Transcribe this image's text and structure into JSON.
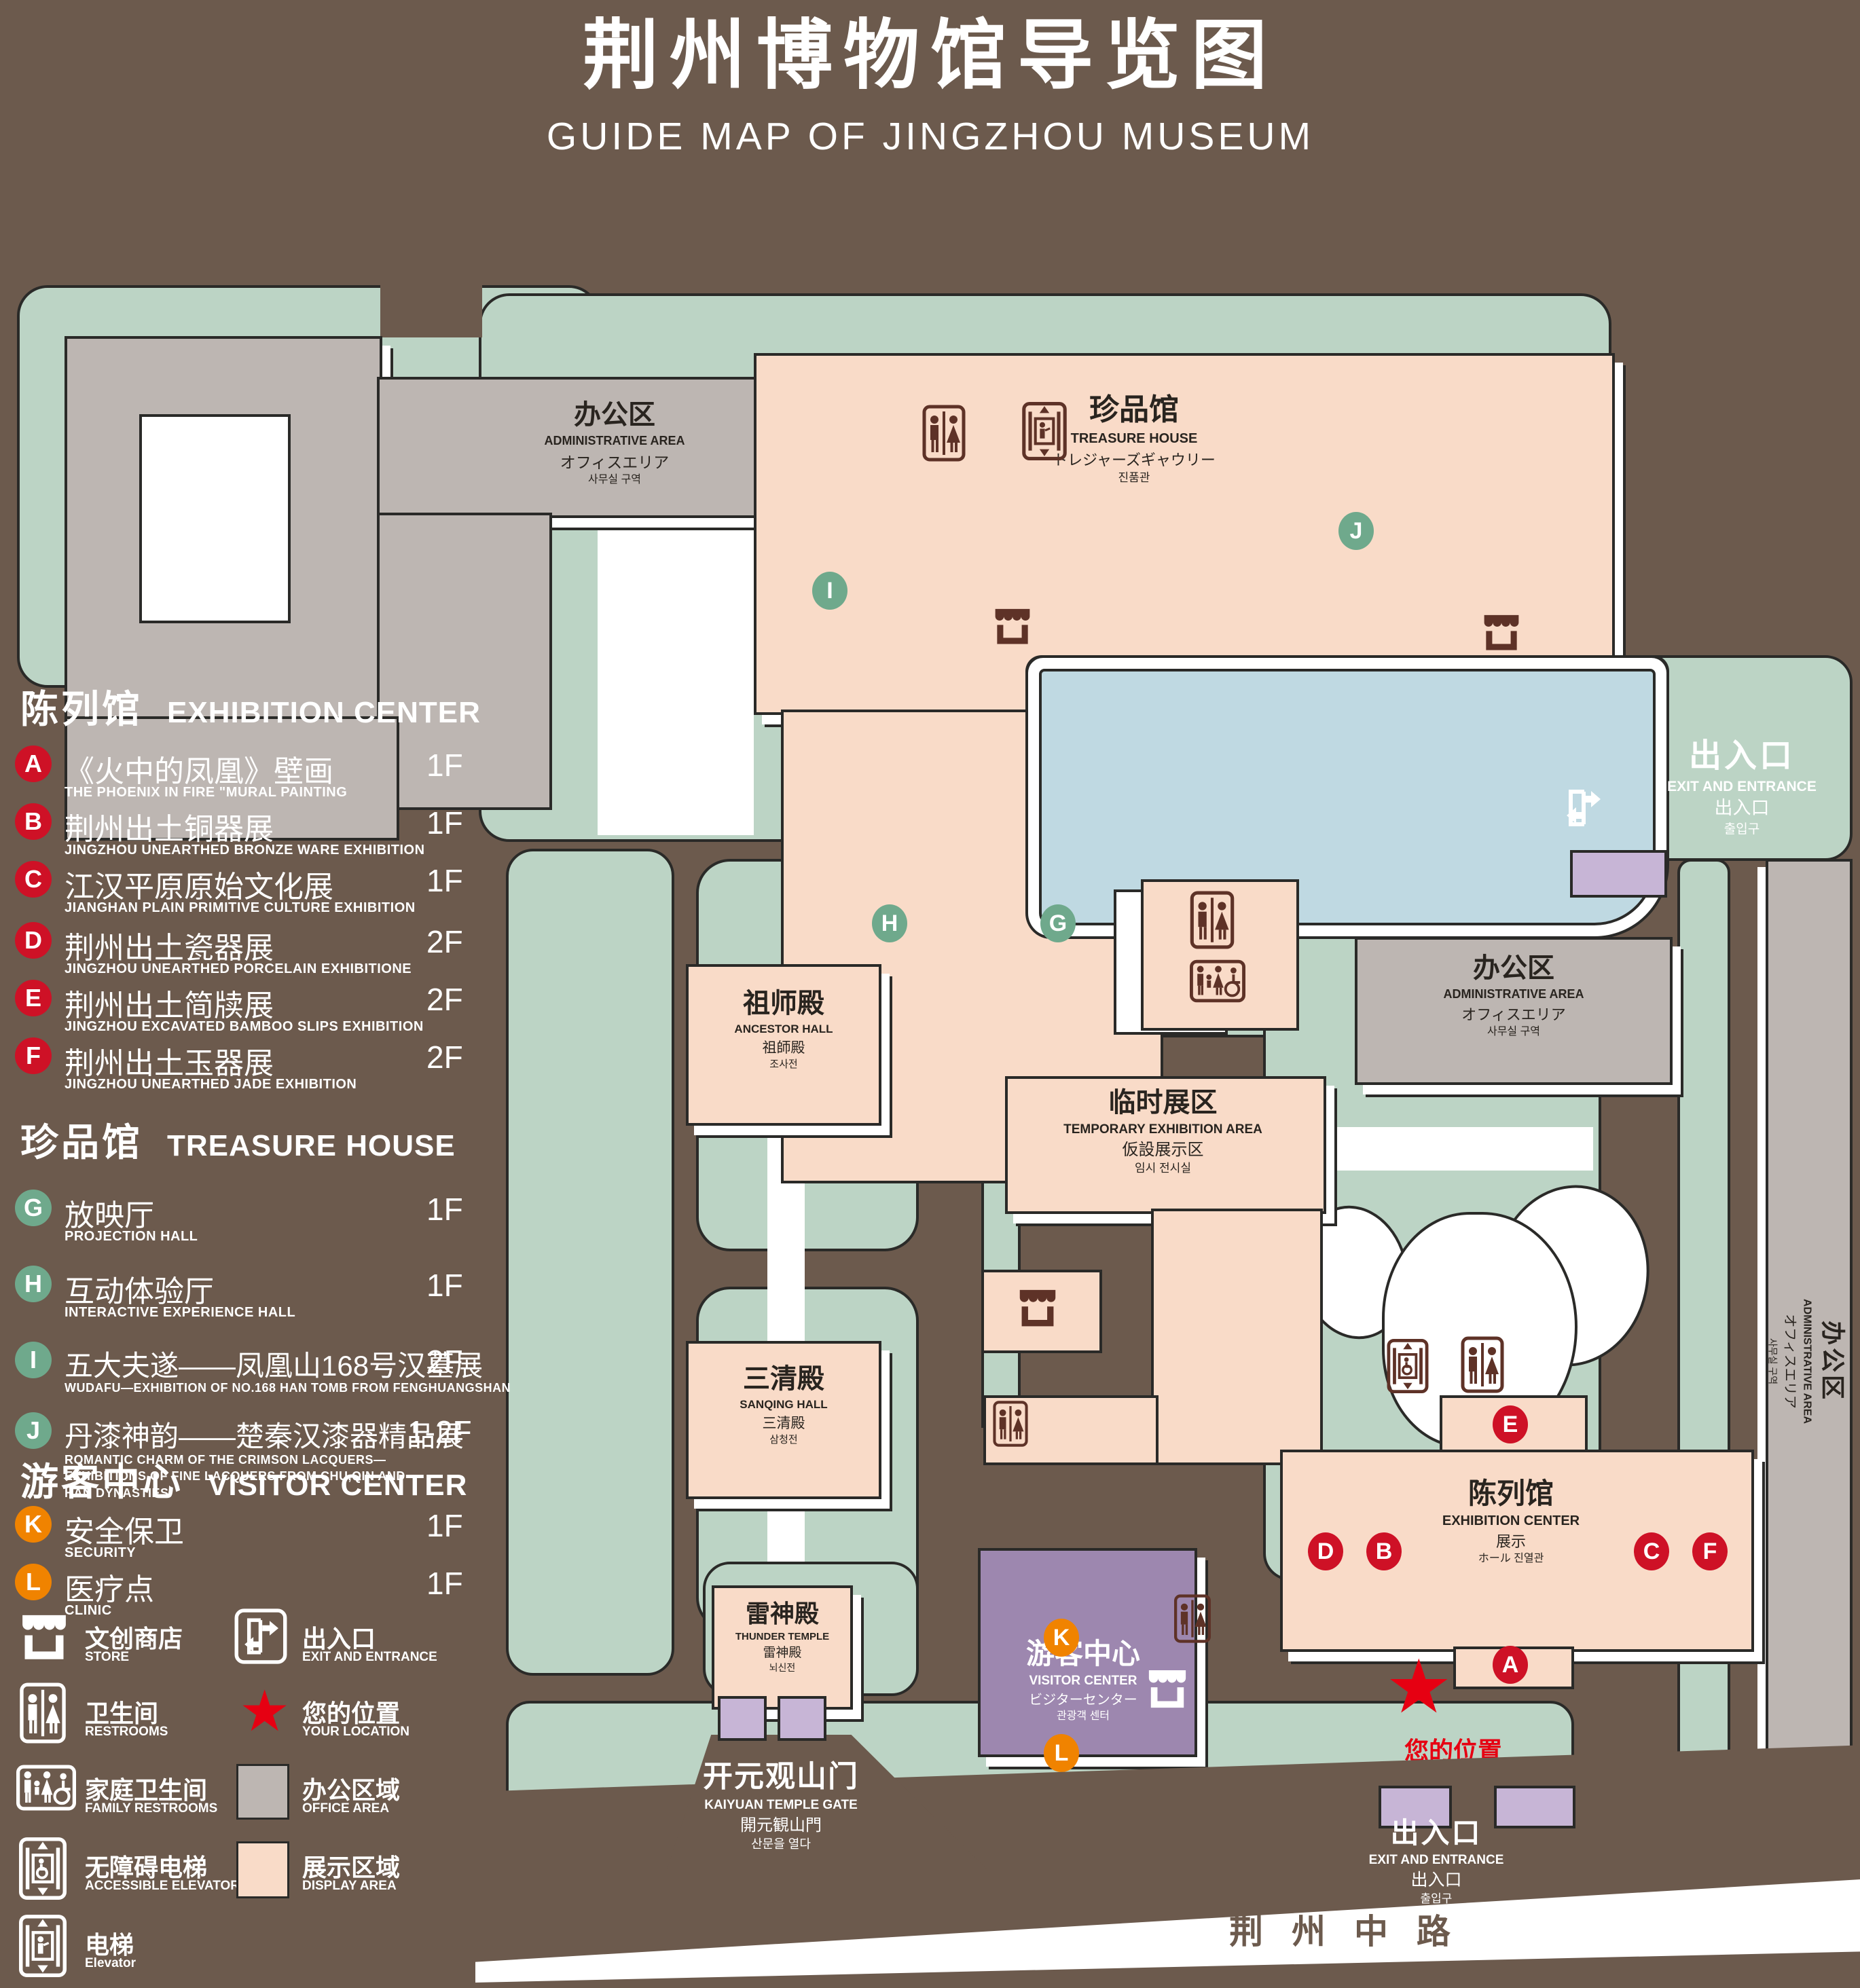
{
  "title": {
    "zh": "荆州博物馆导览图",
    "en": "GUIDE MAP OF JINGZHOU MUSEUM"
  },
  "legend": {
    "sections": [
      {
        "zh": "陈列馆",
        "en": "EXHIBITION CENTER",
        "items": [
          {
            "letter": "A",
            "zh": "《火中的凤凰》壁画",
            "en": "THE PHOENIX IN FIRE \"MURAL PAINTING",
            "floor": "1F"
          },
          {
            "letter": "B",
            "zh": "荆州出土铜器展",
            "en": "JINGZHOU UNEARTHED BRONZE WARE EXHIBITION",
            "floor": "1F"
          },
          {
            "letter": "C",
            "zh": "江汉平原原始文化展",
            "en": "JIANGHAN PLAIN PRIMITIVE CULTURE EXHIBITION",
            "floor": "1F"
          },
          {
            "letter": "D",
            "zh": "荆州出土瓷器展",
            "en": "JINGZHOU UNEARTHED PORCELAIN EXHIBITIONE",
            "floor": "2F"
          },
          {
            "letter": "E",
            "zh": "荆州出土简牍展",
            "en": "JINGZHOU EXCAVATED BAMBOO SLIPS EXHIBITION",
            "floor": "2F"
          },
          {
            "letter": "F",
            "zh": "荆州出土玉器展",
            "en": "JINGZHOU UNEARTHED JADE EXHIBITION",
            "floor": "2F"
          }
        ]
      },
      {
        "zh": "珍品馆",
        "en": "TREASURE HOUSE",
        "items": [
          {
            "letter": "G",
            "zh": "放映厅",
            "en": "PROJECTION HALL",
            "floor": "1F"
          },
          {
            "letter": "H",
            "zh": "互动体验厅",
            "en": "INTERACTIVE EXPERIENCE HALL",
            "floor": "1F"
          },
          {
            "letter": "I",
            "zh": "五大夫遂——凤凰山168号汉墓展",
            "en": "WUDAFU—EXHIBITION OF NO.168 HAN TOMB FROM FENGHUANGSHAN",
            "floor": "2F"
          },
          {
            "letter": "J",
            "zh": "丹漆神韵——楚秦汉漆器精品展",
            "en": "ROMANTIC CHARM OF THE CRIMSON LACQUERS—EXHIBITIONS OF FINE LACQUERS FROM CHU,QIN AND HAN DYNASTIES",
            "floor": "1-2F"
          }
        ]
      },
      {
        "zh": "游客中心",
        "en": "VISITOR CENTER",
        "items": [
          {
            "letter": "K",
            "zh": "安全保卫",
            "en": "SECURITY",
            "floor": "1F"
          },
          {
            "letter": "L",
            "zh": "医疗点",
            "en": "CLINIC",
            "floor": "1F"
          }
        ]
      }
    ],
    "symbols": [
      {
        "zh": "文创商店",
        "en": "STORE"
      },
      {
        "zh": "出入口",
        "en": "EXIT AND ENTRANCE"
      },
      {
        "zh": "卫生间",
        "en": "RESTROOMS"
      },
      {
        "zh": "您的位置",
        "en": "YOUR LOCATION"
      },
      {
        "zh": "家庭卫生间",
        "en": "FAMILY RESTROOMS"
      },
      {
        "zh": "办公区域",
        "en": "OFFICE AREA"
      },
      {
        "zh": "无障碍电梯",
        "en": "ACCESSIBLE ELEVATOR"
      },
      {
        "zh": "展示区域",
        "en": "DISPLAY AREA"
      },
      {
        "zh": "电梯",
        "en": "Elevator"
      }
    ]
  },
  "map": {
    "treasure_house": {
      "zh": "珍品馆",
      "en": "TREASURE HOUSE",
      "ja": "トレジャーズギャウリー",
      "ko": "진품관"
    },
    "admin_area": {
      "zh": "办公区",
      "en": "ADMINISTRATIVE AREA",
      "ja": "オフィスエリア",
      "ko": "사무실 구역"
    },
    "ancestor_hall": {
      "zh": "祖师殿",
      "en": "ANCESTOR HALL",
      "ja": "祖師殿",
      "ko": "조사전"
    },
    "temporary_exhibition": {
      "zh": "临时展区",
      "en": "TEMPORARY EXHIBITION AREA",
      "ja": "仮設展示区",
      "ko": "임시 전시실"
    },
    "sanqing_hall": {
      "zh": "三清殿",
      "en": "SANQING HALL",
      "ja": "三清殿",
      "ko": "삼청전"
    },
    "thunder_temple": {
      "zh": "雷神殿",
      "en": "THUNDER TEMPLE",
      "ja": "雷神殿",
      "ko": "뇌신전"
    },
    "visitor_center": {
      "zh": "游客中心",
      "en": "VISITOR CENTER",
      "ja": "ビジターセンター",
      "ko": "관광객 센터"
    },
    "exhibition_center": {
      "zh": "陈列馆",
      "en": "EXHIBITION CENTER",
      "ja": "展示",
      "ko": "ホール 진열관"
    },
    "exit": {
      "zh": "出入口",
      "en": "EXIT AND ENTRANCE",
      "ja": "出入口",
      "ko": "출입구"
    },
    "gate": {
      "zh": "开元观山门",
      "en": "KAIYUAN TEMPLE GATE",
      "ja": "開元観山門",
      "ko": "산문을 열다"
    },
    "road": "荆 州 中 路",
    "your_location": "您的位置",
    "markers": {
      "A": "A",
      "B": "B",
      "C": "C",
      "D": "D",
      "E": "E",
      "F": "F",
      "G": "G",
      "H": "H",
      "I": "I",
      "J": "J",
      "K": "K",
      "L": "L"
    }
  },
  "colors": {
    "background": "#6C5A4D",
    "green_zone": "#BCD4C5",
    "display_area": "#F9DBC8",
    "office_area": "#BDB6B2",
    "pond": "#BFD9E2",
    "visitor_center": "#9D87AF",
    "gate_block": "#C7B5D6",
    "marker_red": "#CE1126",
    "marker_green": "#6FA98C",
    "marker_orange": "#F08300",
    "icon_brown": "#5E3227",
    "star_red": "#E60012"
  }
}
